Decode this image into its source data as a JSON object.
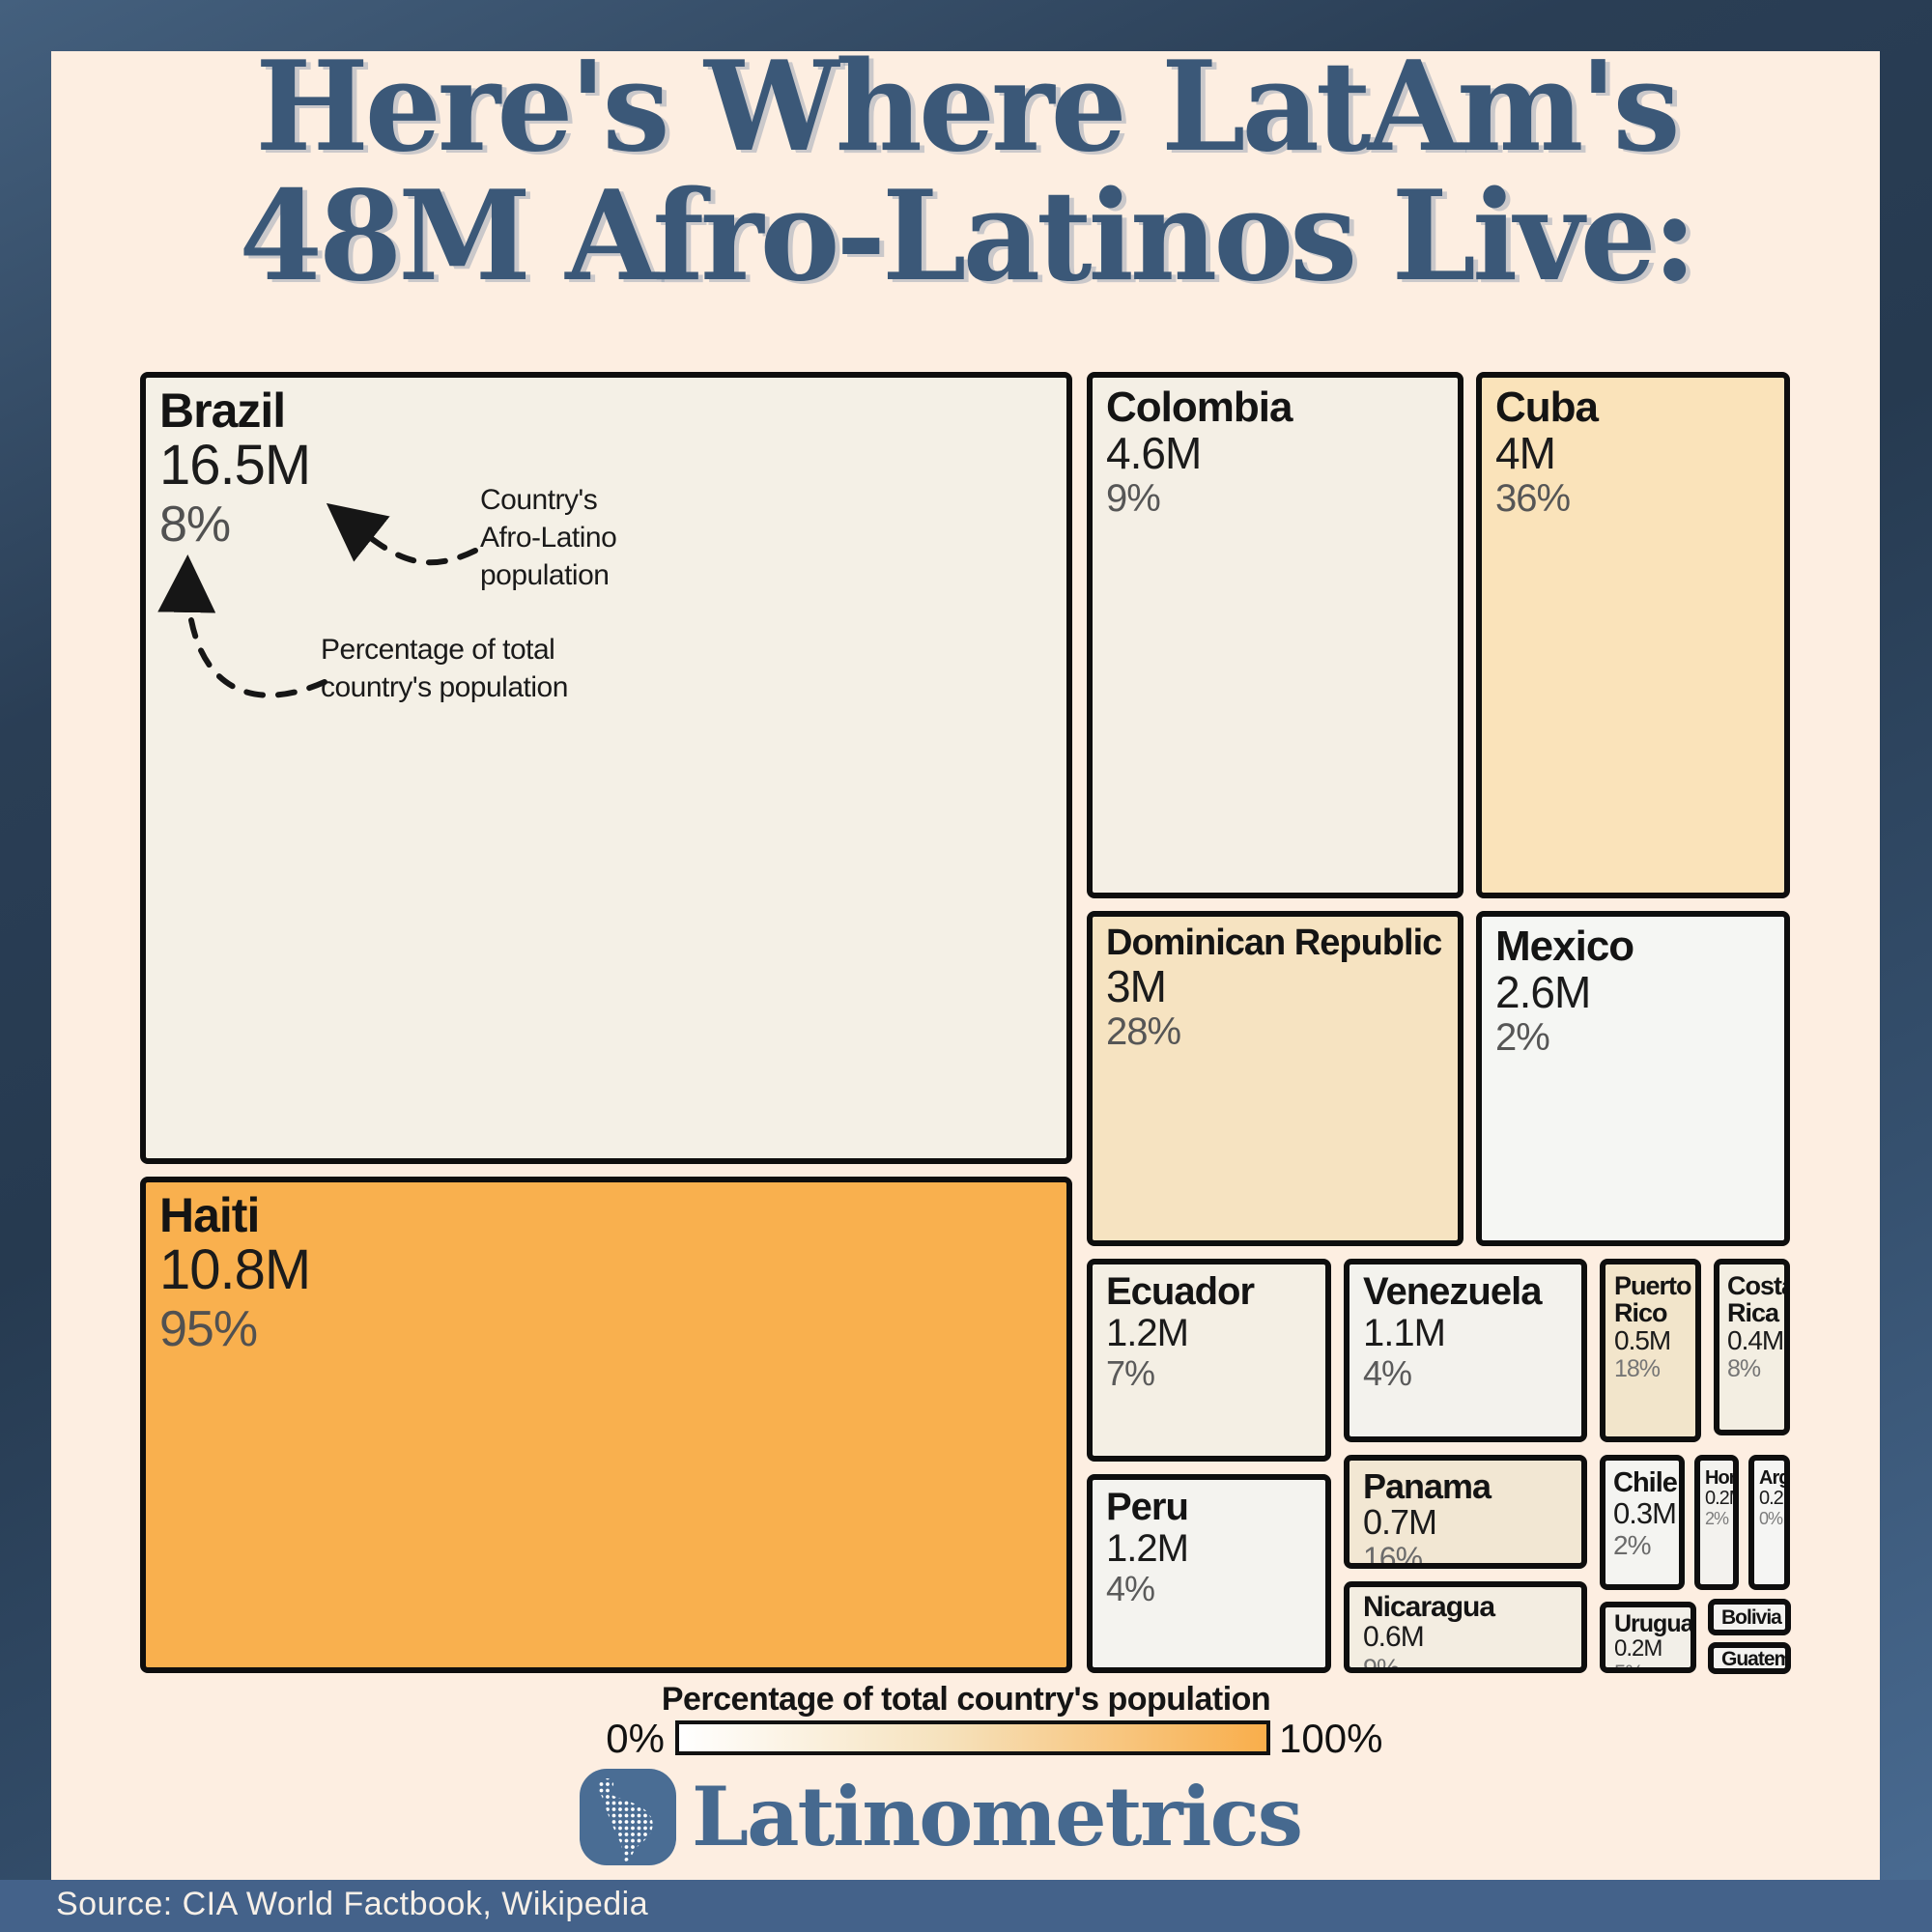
{
  "title": {
    "line1": "Here's Where LatAm's",
    "line2": "48M Afro-Latinos Live:"
  },
  "annotations": {
    "population_note": "Country's\nAfro-Latino\npopulation",
    "percent_note": "Percentage of total\ncountry's population"
  },
  "treemap": {
    "boxes": [
      {
        "name": "Brazil",
        "value": "16.5M",
        "percent": "8%",
        "color": "#F4F0E6"
      },
      {
        "name": "Haiti",
        "value": "10.8M",
        "percent": "95%",
        "color": "#F9B04E"
      },
      {
        "name": "Colombia",
        "value": "4.6M",
        "percent": "9%",
        "color": "#F4EFE5"
      },
      {
        "name": "Cuba",
        "value": "4M",
        "percent": "36%",
        "color": "#FAE3BA"
      },
      {
        "name": "Dominican Republic",
        "value": "3M",
        "percent": "28%",
        "color": "#F6E3C1"
      },
      {
        "name": "Mexico",
        "value": "2.6M",
        "percent": "2%",
        "color": "#F5F6F3"
      },
      {
        "name": "Ecuador",
        "value": "1.2M",
        "percent": "7%",
        "color": "#F4EFE4"
      },
      {
        "name": "Peru",
        "value": "1.2M",
        "percent": "4%",
        "color": "#F4F3EF"
      },
      {
        "name": "Venezuela",
        "value": "1.1M",
        "percent": "4%",
        "color": "#F3F2ED"
      },
      {
        "name": "Panama",
        "value": "0.7M",
        "percent": "16%",
        "color": "#F2E7D3"
      },
      {
        "name": "Nicaragua",
        "value": "0.6M",
        "percent": "9%",
        "color": "#F3EDE1"
      },
      {
        "name": "Puerto Rico",
        "value": "0.5M",
        "percent": "18%",
        "color": "#F2E5CB"
      },
      {
        "name": "Costa Rica",
        "value": "0.4M",
        "percent": "8%",
        "color": "#F3EEE2"
      },
      {
        "name": "Chile",
        "value": "0.3M",
        "percent": "2%",
        "color": "#F4F4F1"
      },
      {
        "name": "Hond.",
        "value": "0.2M",
        "percent": "2%",
        "color": "#F3F2EE"
      },
      {
        "name": "Arg.",
        "value": "0.2M",
        "percent": "0%",
        "color": "#F5F5F3"
      },
      {
        "name": "Uruguay",
        "value": "0.2M",
        "percent": "5%",
        "color": "#F2EFE8"
      },
      {
        "name": "Bolivia",
        "value": ".1M",
        "percent": "1%",
        "color": "#F4F3F0"
      },
      {
        "name": "Guatemala",
        "value": ".1M",
        "percent": "",
        "color": "#F4F3F0"
      }
    ]
  },
  "legend": {
    "title": "Percentage of total country's population",
    "min": "0%",
    "max": "100%",
    "gradient_start": "#FFFFFF",
    "gradient_end": "#F9AE4B"
  },
  "footer": {
    "brand": "Latinometrics",
    "source": "Source: CIA World Factbook, Wikipedia"
  },
  "chart_data": {
    "type": "treemap",
    "title": "Here's Where LatAm's 48M Afro-Latinos Live:",
    "total_label": "48M",
    "value_unit": "millions of Afro-Latinos",
    "color_encoding": "Percentage of total country's population, white (0%) to orange (100%)",
    "points": [
      {
        "country": "Brazil",
        "population_m": 16.5,
        "percent_of_country": 8
      },
      {
        "country": "Haiti",
        "population_m": 10.8,
        "percent_of_country": 95
      },
      {
        "country": "Colombia",
        "population_m": 4.6,
        "percent_of_country": 9
      },
      {
        "country": "Cuba",
        "population_m": 4.0,
        "percent_of_country": 36
      },
      {
        "country": "Dominican Republic",
        "population_m": 3.0,
        "percent_of_country": 28
      },
      {
        "country": "Mexico",
        "population_m": 2.6,
        "percent_of_country": 2
      },
      {
        "country": "Ecuador",
        "population_m": 1.2,
        "percent_of_country": 7
      },
      {
        "country": "Peru",
        "population_m": 1.2,
        "percent_of_country": 4
      },
      {
        "country": "Venezuela",
        "population_m": 1.1,
        "percent_of_country": 4
      },
      {
        "country": "Panama",
        "population_m": 0.7,
        "percent_of_country": 16
      },
      {
        "country": "Nicaragua",
        "population_m": 0.6,
        "percent_of_country": 9
      },
      {
        "country": "Puerto Rico",
        "population_m": 0.5,
        "percent_of_country": 18
      },
      {
        "country": "Costa Rica",
        "population_m": 0.4,
        "percent_of_country": 8
      },
      {
        "country": "Chile",
        "population_m": 0.3,
        "percent_of_country": 2
      },
      {
        "country": "Honduras",
        "population_m": 0.2,
        "percent_of_country": 2
      },
      {
        "country": "Argentina",
        "population_m": 0.2,
        "percent_of_country": 0
      },
      {
        "country": "Uruguay",
        "population_m": 0.2,
        "percent_of_country": 5
      },
      {
        "country": "Bolivia",
        "population_m": 0.1,
        "percent_of_country": 1
      },
      {
        "country": "Guatemala",
        "population_m": 0.1,
        "percent_of_country": null
      }
    ]
  }
}
